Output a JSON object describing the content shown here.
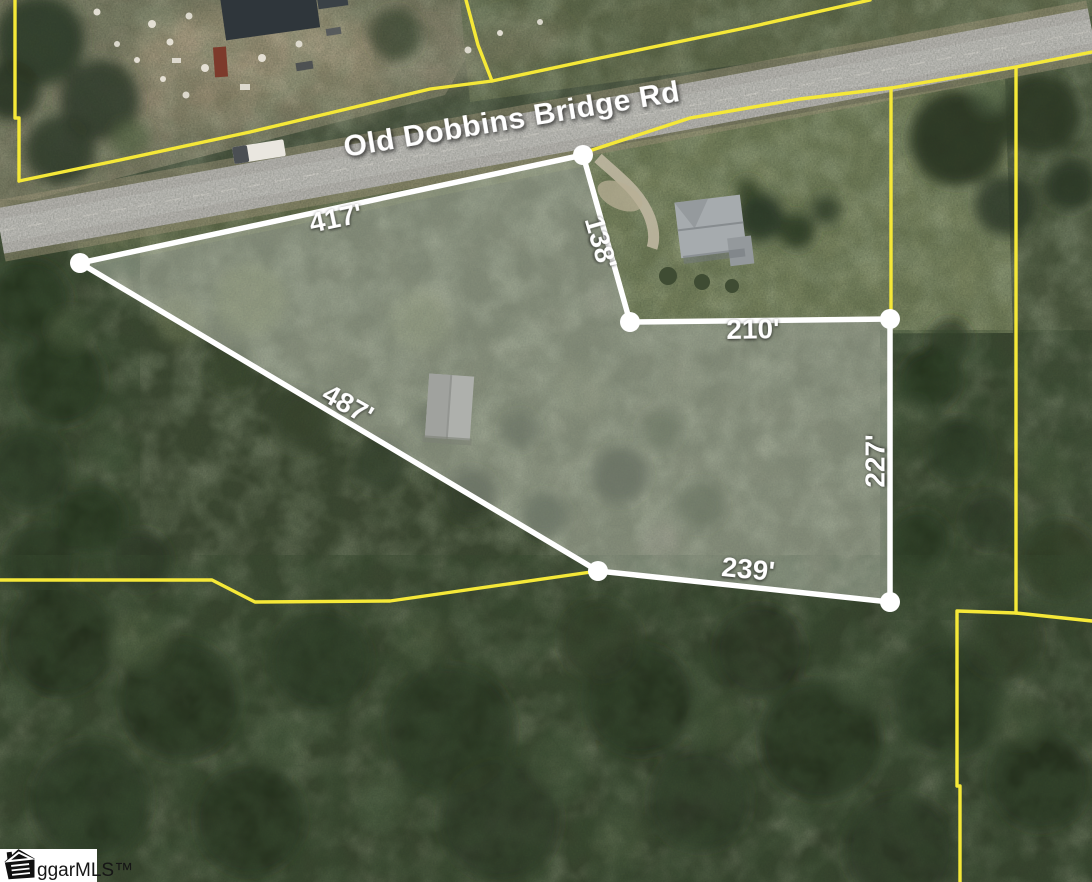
{
  "map": {
    "road_label": {
      "text": "Old Dobbins Bridge Rd",
      "x": 512,
      "y": 121,
      "rotate": -9.5
    },
    "watermark": {
      "text": "ggarMLS™"
    },
    "colors": {
      "parcel_line": "#ffffff",
      "parcel_fill": "rgba(255,255,255,0.27)",
      "boundary_line": "#f5e838"
    },
    "parcel": {
      "vertex_radius": 10,
      "vertices": [
        [
          583,
          155
        ],
        [
          80,
          263
        ],
        [
          598,
          571
        ],
        [
          890,
          602
        ],
        [
          890,
          319
        ],
        [
          630,
          322
        ]
      ],
      "edge_labels": [
        {
          "text": "417'",
          "x": 336,
          "y": 220,
          "rotate": -12
        },
        {
          "text": "487'",
          "x": 347,
          "y": 406,
          "rotate": 29.5
        },
        {
          "text": "239'",
          "x": 748,
          "y": 571,
          "rotate": 5.5
        },
        {
          "text": "227'",
          "x": 877,
          "y": 461,
          "rotate": -90
        },
        {
          "text": "210'",
          "x": 753,
          "y": 331,
          "rotate": -1
        },
        {
          "text": "138'",
          "x": 599,
          "y": 243,
          "rotate": 74
        }
      ]
    },
    "boundaries": [
      {
        "name": "west-edge",
        "points": [
          [
            15,
            0
          ],
          [
            15,
            118
          ],
          [
            19,
            118
          ],
          [
            19,
            181
          ]
        ]
      },
      {
        "name": "north-roadside",
        "points": [
          [
            19,
            181
          ],
          [
            120,
            160
          ],
          [
            250,
            132
          ],
          [
            330,
            113
          ],
          [
            430,
            89
          ],
          [
            492,
            81
          ],
          [
            600,
            58
          ],
          [
            750,
            27
          ],
          [
            870,
            0
          ]
        ]
      },
      {
        "name": "north-branch",
        "points": [
          [
            466,
            0
          ],
          [
            478,
            45
          ],
          [
            492,
            81
          ]
        ]
      },
      {
        "name": "south-roadside",
        "points": [
          [
            583,
            153
          ],
          [
            690,
            118
          ],
          [
            800,
            99
          ],
          [
            891,
            88
          ],
          [
            1016,
            67
          ],
          [
            1092,
            52
          ]
        ]
      },
      {
        "name": "east-vertical-a",
        "points": [
          [
            891,
            88
          ],
          [
            891,
            319
          ]
        ]
      },
      {
        "name": "east-vertical-b",
        "points": [
          [
            1016,
            67
          ],
          [
            1016,
            613
          ]
        ]
      },
      {
        "name": "southeast-block",
        "points": [
          [
            1092,
            621
          ],
          [
            1016,
            613
          ],
          [
            957,
            611
          ],
          [
            957,
            786
          ],
          [
            960,
            786
          ],
          [
            960,
            882
          ]
        ]
      },
      {
        "name": "southwest-line",
        "points": [
          [
            0,
            580
          ],
          [
            212,
            580
          ],
          [
            255,
            602
          ],
          [
            390,
            601
          ],
          [
            598,
            571
          ]
        ]
      }
    ]
  }
}
